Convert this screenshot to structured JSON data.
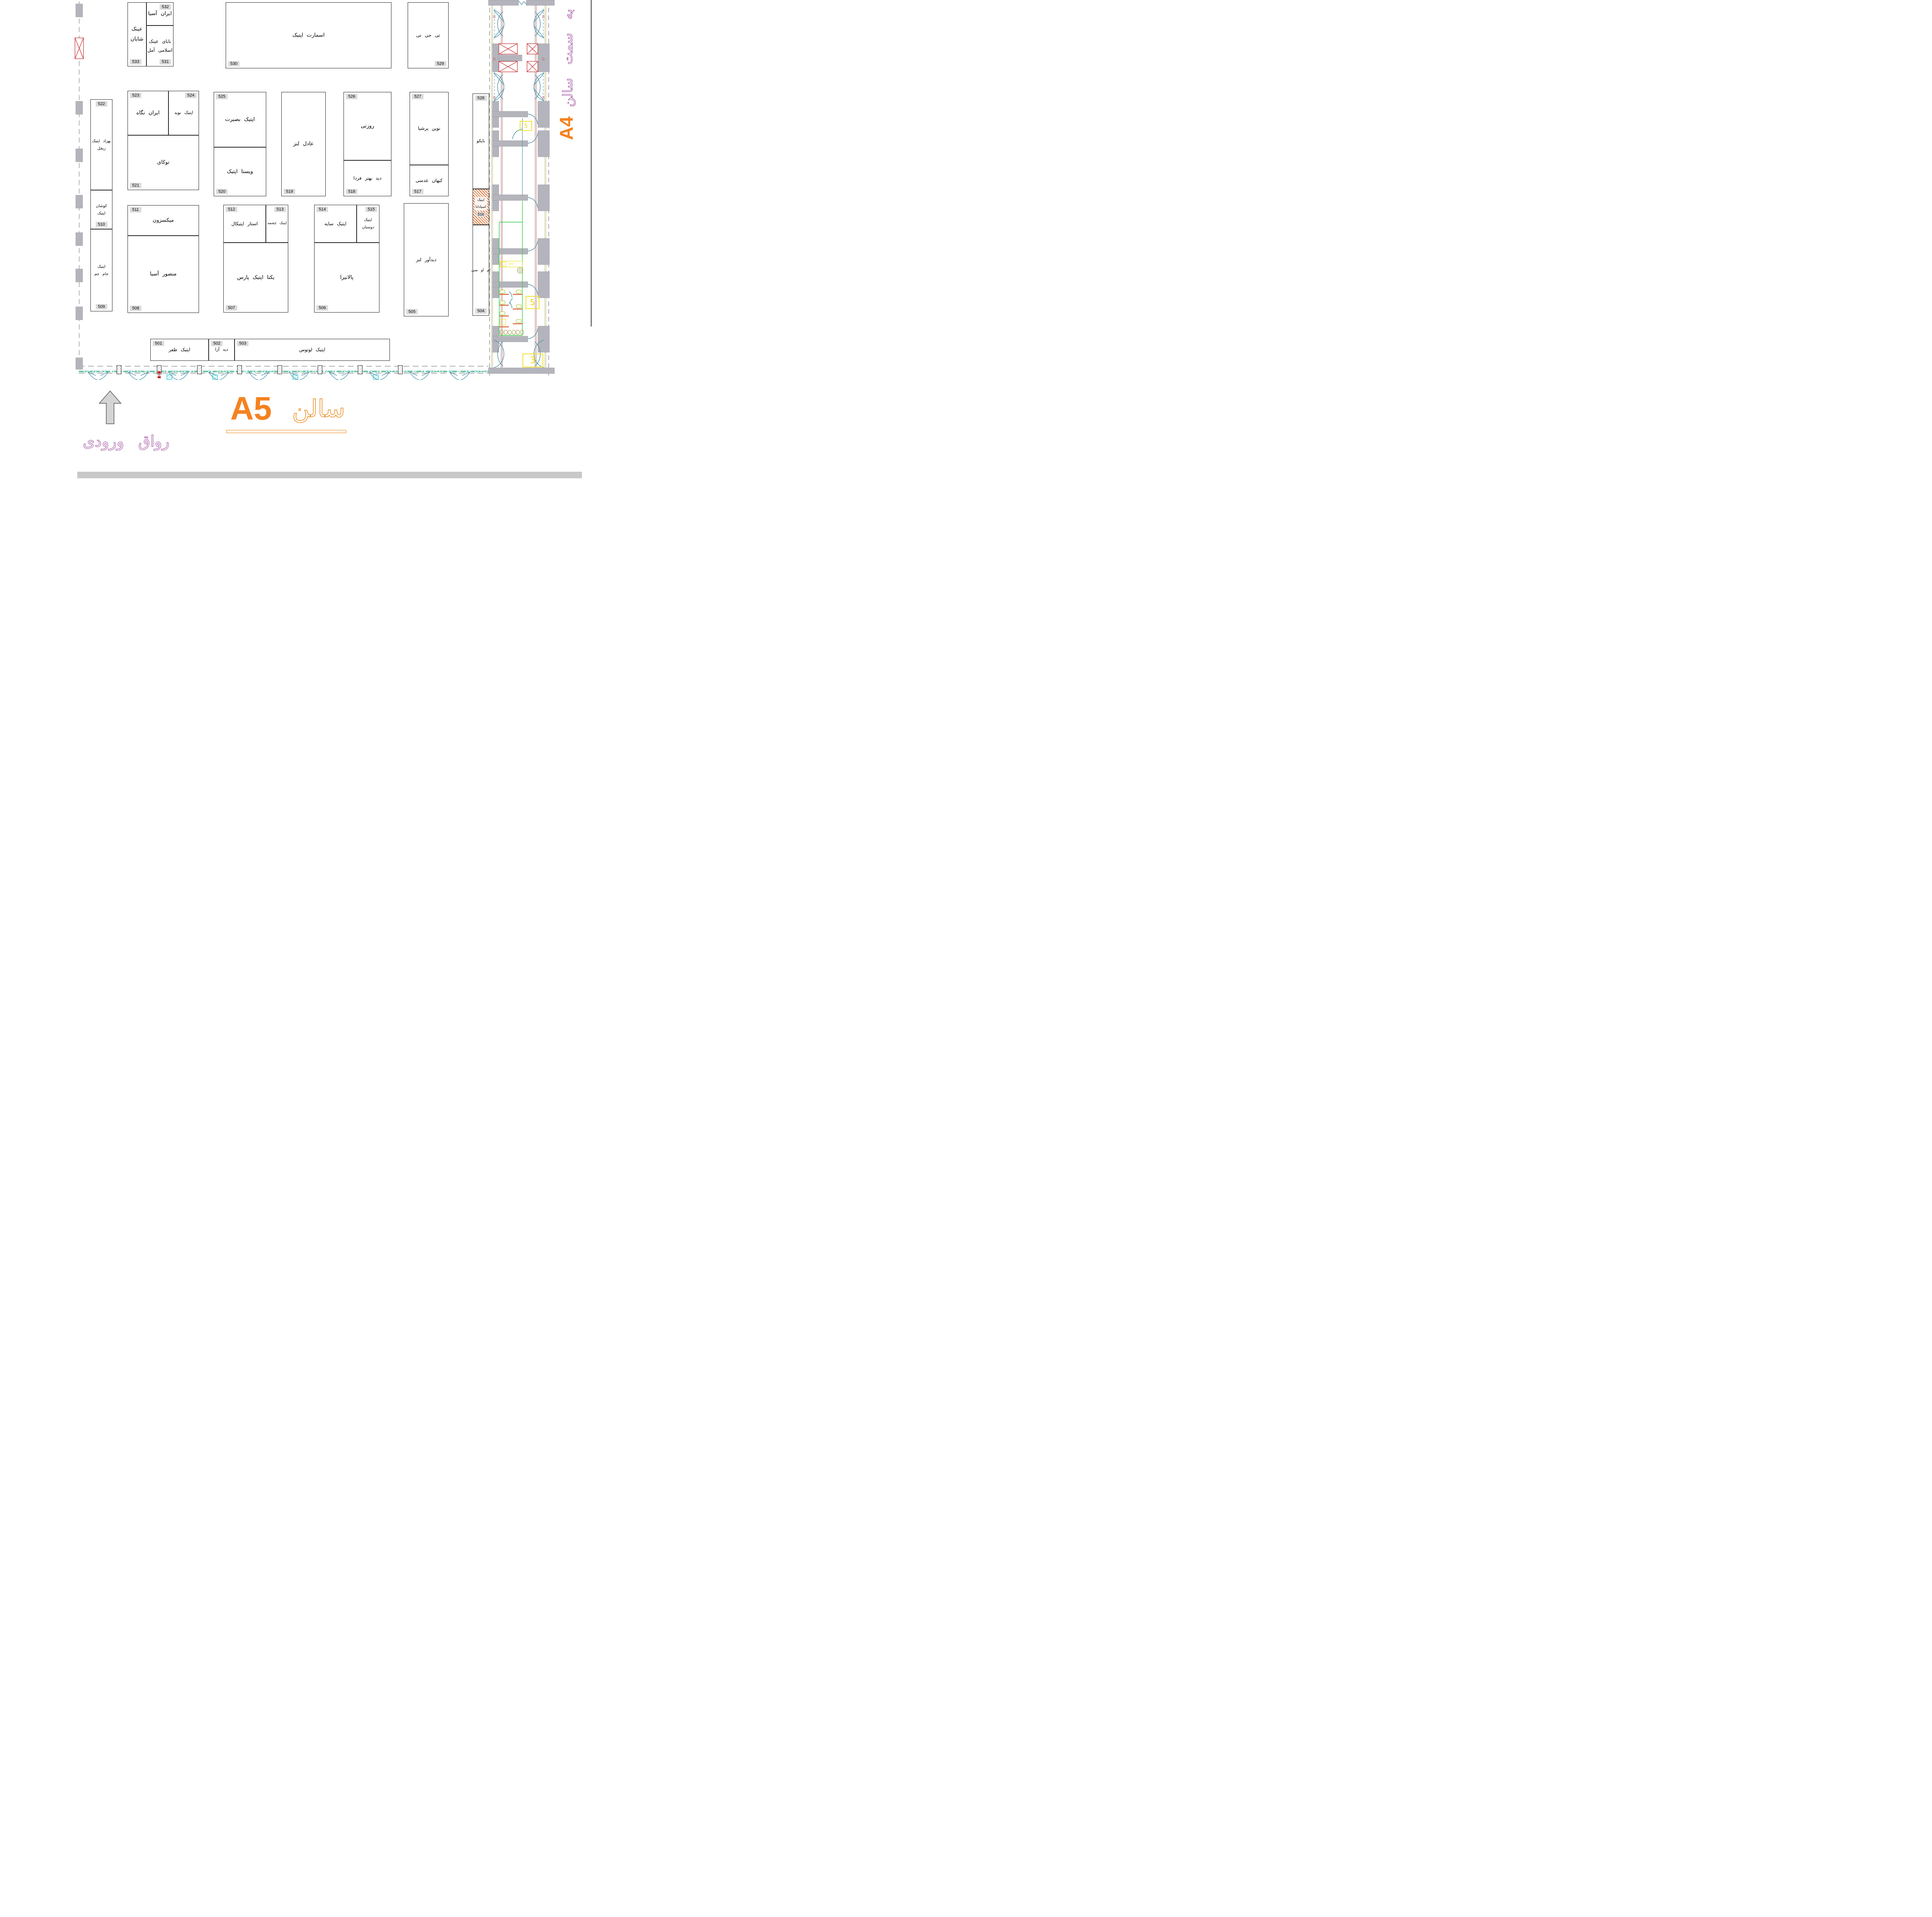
{
  "title": {
    "hall_latin": "A5",
    "hall_fa": "سالن",
    "entrance": "رواق ورودی",
    "to_hall": "به سمت سالن",
    "adjacent_hall": "A4"
  },
  "corridor": {
    "markers": [
      "5",
      "5",
      "3"
    ]
  },
  "booths": [
    {
      "number": "533",
      "name": "عینک شایان"
    },
    {
      "number": "532",
      "name": "ایران آسیا"
    },
    {
      "number": "531",
      "name": "بابای عینک\nاسلامی آمل"
    },
    {
      "number": "530",
      "name": "اسمارت اپتیک"
    },
    {
      "number": "529",
      "name": "تی جی تی"
    },
    {
      "number": "522",
      "name": "بهزاد اپتیک\nریچل"
    },
    {
      "number": "523",
      "name": "ایران نگاه"
    },
    {
      "number": "524",
      "name": "اپتیک نوید"
    },
    {
      "number": "521",
      "name": "توکای"
    },
    {
      "number": "525",
      "name": "اپتیک بصیرت"
    },
    {
      "number": "520",
      "name": "ویستا اپتیک"
    },
    {
      "number": "519",
      "name": "عادل لنز"
    },
    {
      "number": "526",
      "name": "روزتی"
    },
    {
      "number": "518",
      "name": "دید بهتر فردا"
    },
    {
      "number": "527",
      "name": "نوین پرشیا"
    },
    {
      "number": "517",
      "name": "کیهان عدسی"
    },
    {
      "number": "528",
      "name": "باپکو"
    },
    {
      "number": "516",
      "name": "اپتیک\nاسپادانا"
    },
    {
      "number": "511",
      "name": "میکسزون"
    },
    {
      "number": "508",
      "name": "منصور آسیا"
    },
    {
      "number": "512",
      "name": "استار اپتیکال"
    },
    {
      "number": "513",
      "name": "اپتیک چشمه"
    },
    {
      "number": "507",
      "name": "یکتا اپتیک پارس"
    },
    {
      "number": "514",
      "name": "اپتیک سایه"
    },
    {
      "number": "515",
      "name": "اپتیک\nدوستان"
    },
    {
      "number": "506",
      "name": "پالانیرا"
    },
    {
      "number": "505",
      "name": "دیدآور لنز"
    },
    {
      "number": "504",
      "name": "ام او سی"
    },
    {
      "number": "501",
      "name": "اپتیک ظفر"
    },
    {
      "number": "502",
      "name": "دید آرا"
    },
    {
      "number": "503",
      "name": "اپتیک لوتوس"
    },
    {
      "number": "510",
      "name": "کوشان\nاپتیک"
    },
    {
      "number": "509",
      "name": "اپتیک\nجام جم"
    }
  ]
}
